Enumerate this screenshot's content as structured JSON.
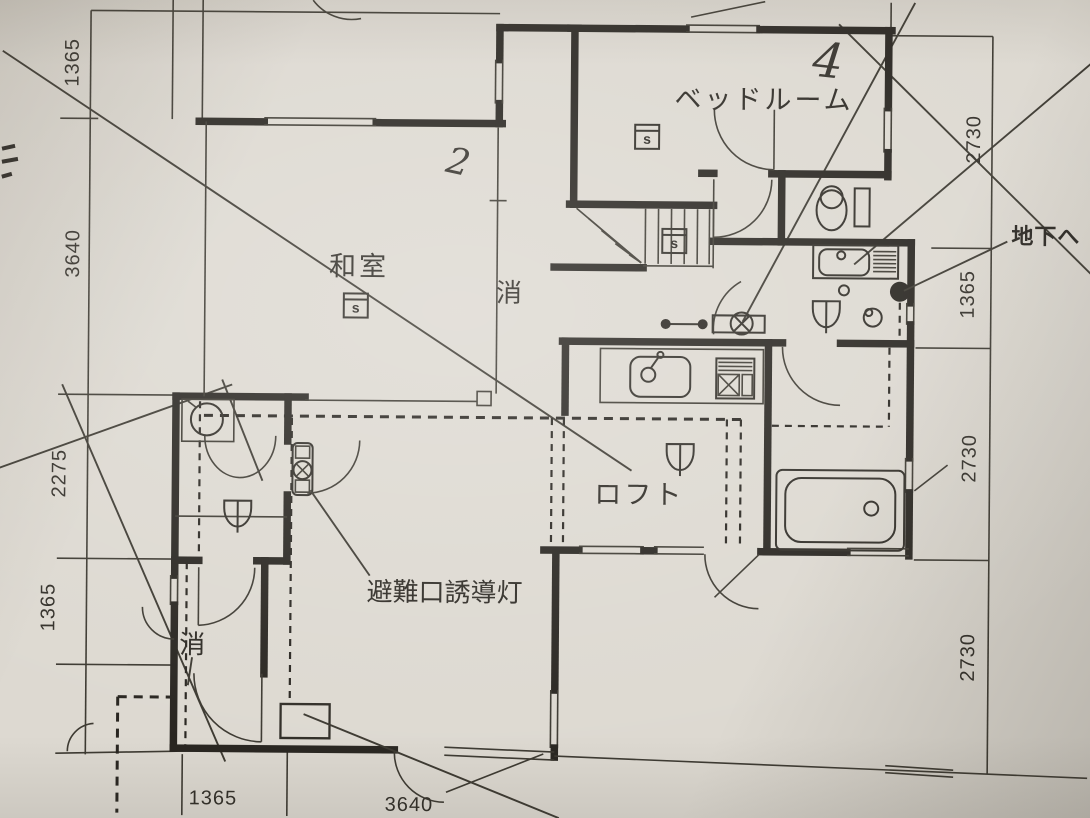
{
  "rooms": {
    "bedroom": "ベッドルーム",
    "japanese_room": "和室",
    "loft": "ロフト"
  },
  "annotations": {
    "to_basement": "地下へ",
    "exit_light": "避難口誘導灯",
    "extinguisher_upper": "消",
    "extinguisher_lower": "消",
    "handwritten_upper": "4",
    "handwritten_lower": "2",
    "detector_bedroom": "s",
    "detector_stairs": "s",
    "detector_washitsu": "s"
  },
  "dimensions": {
    "left": [
      "1365",
      "3640",
      "2275",
      "1365"
    ],
    "right": [
      "2730",
      "1365",
      "2730",
      "2730"
    ],
    "bottom": [
      "1365",
      "3640"
    ]
  },
  "colors": {
    "paper": "#ddd9d1",
    "ink": "#26231e"
  }
}
